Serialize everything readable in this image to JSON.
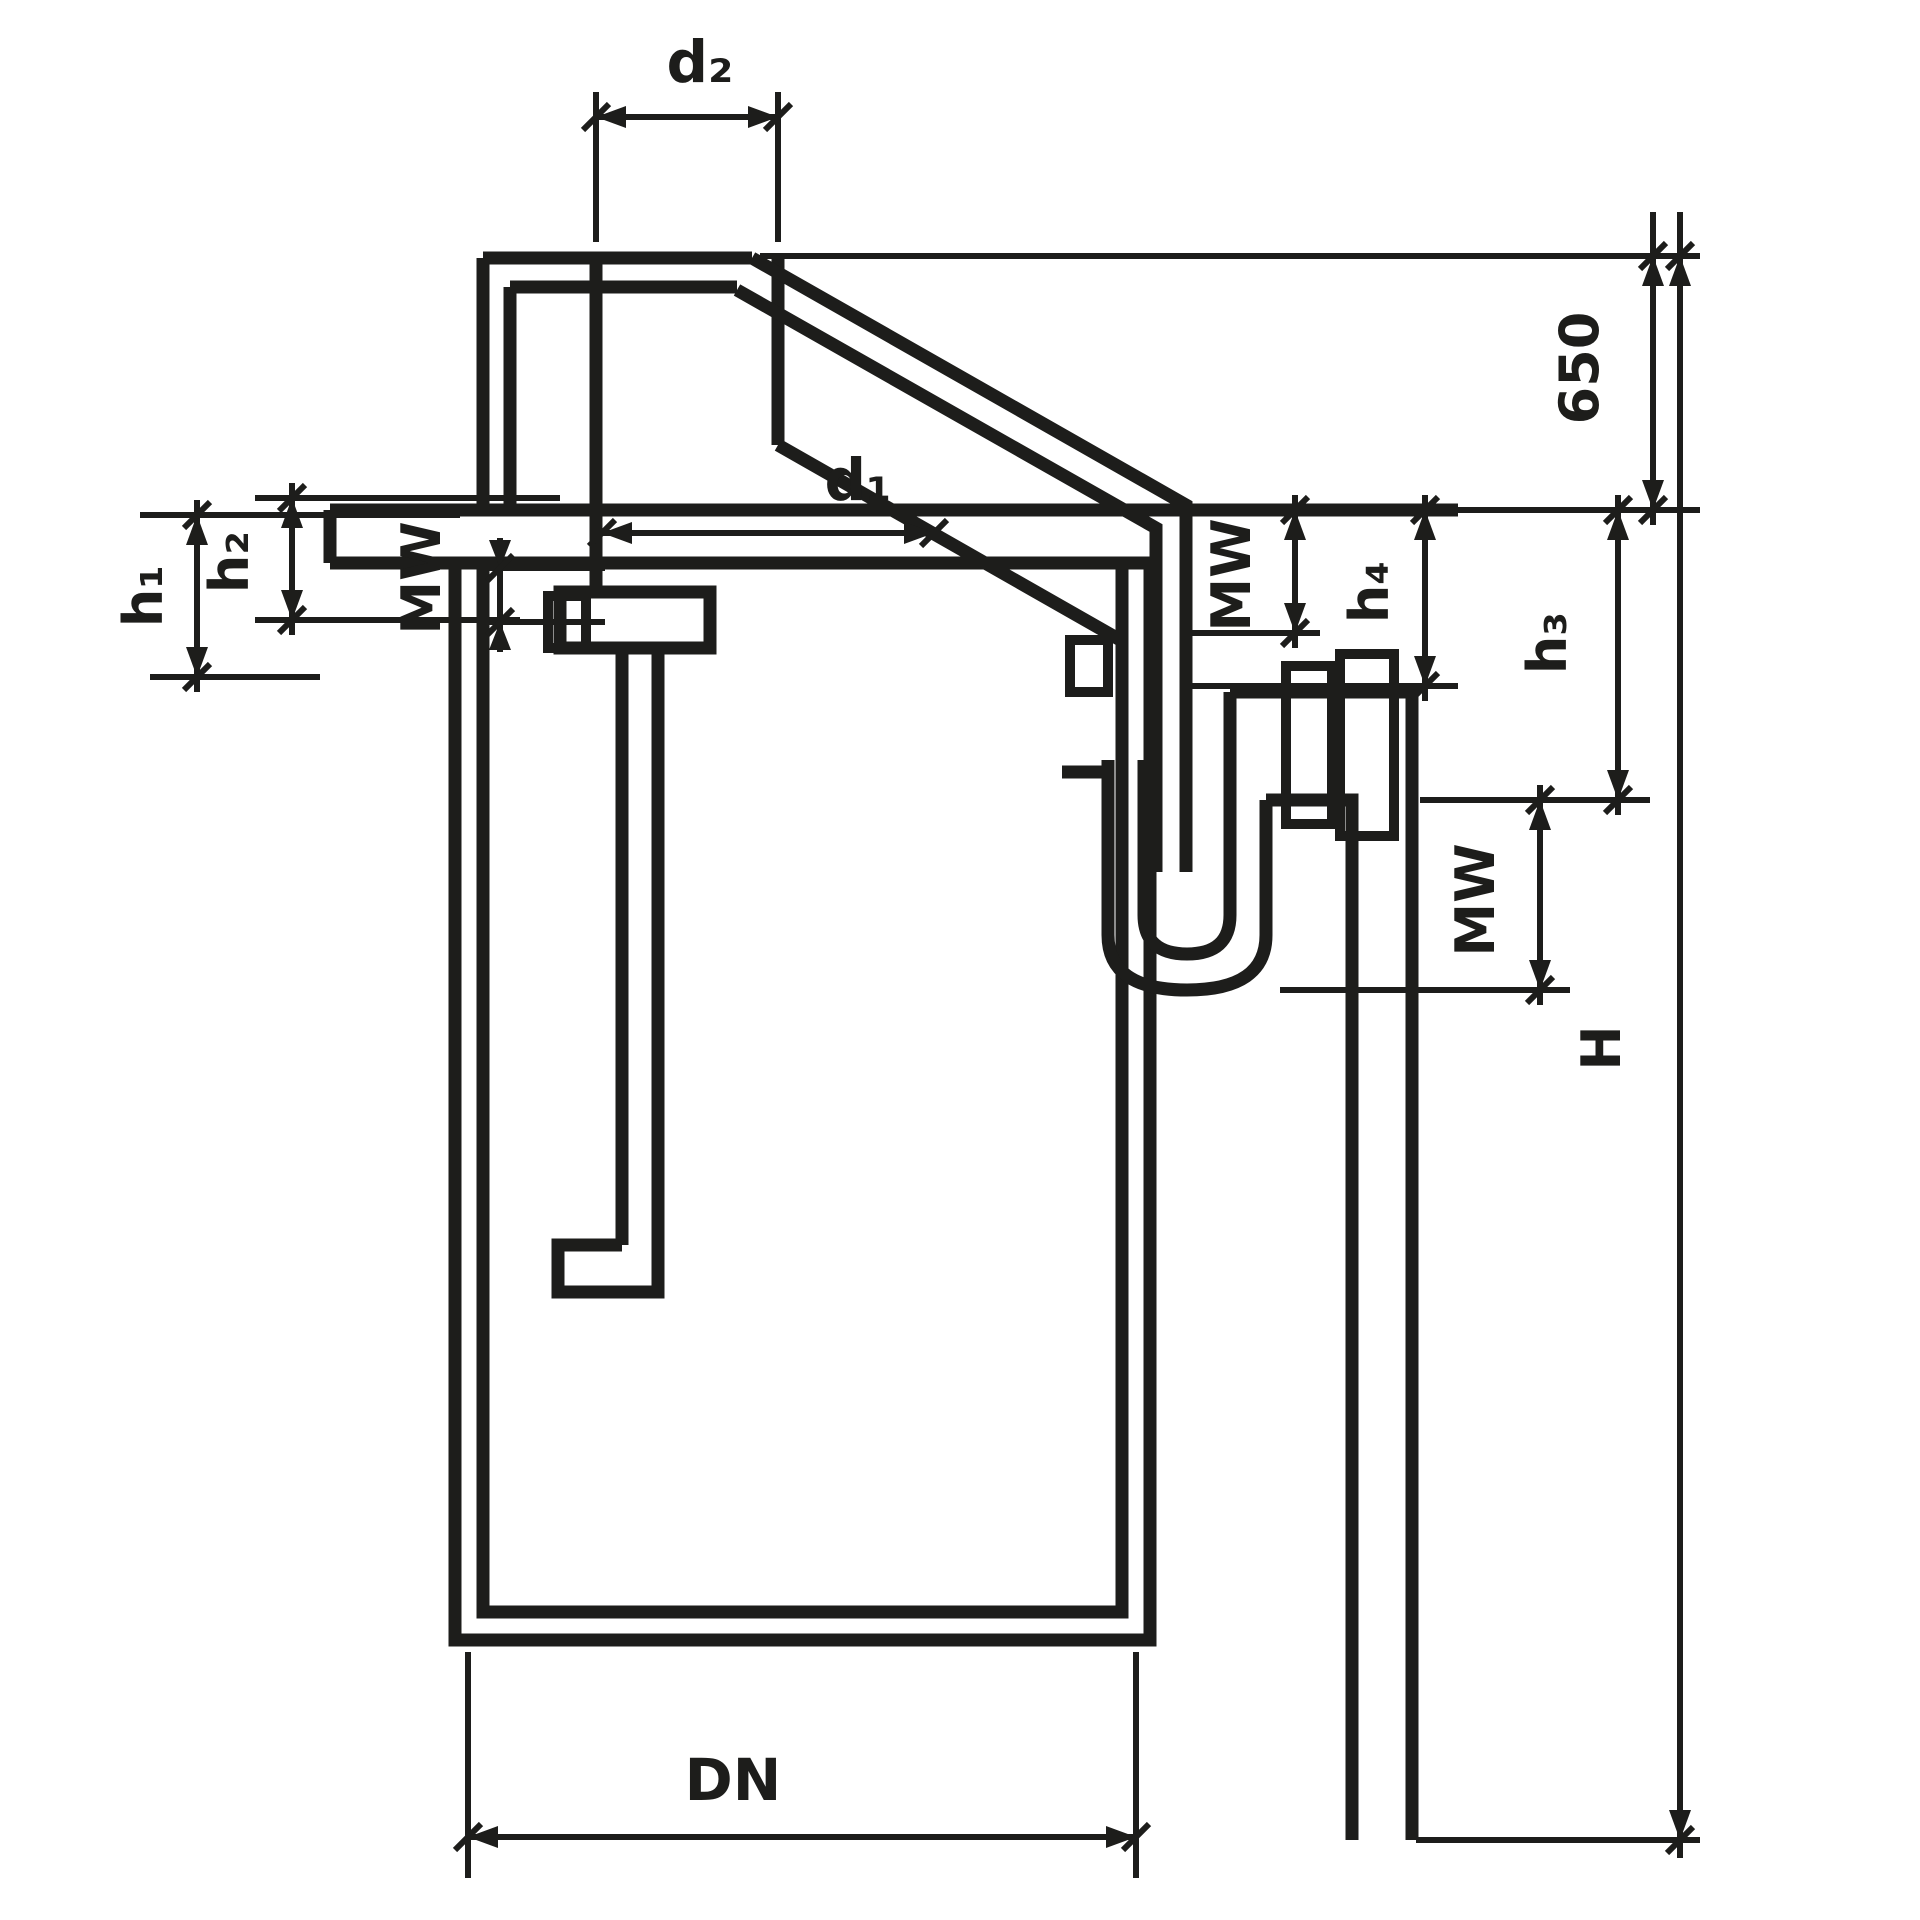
{
  "drawing": {
    "labels": {
      "d2": "d₂",
      "d1": "d₁",
      "dn": "DN",
      "h1": "h₁",
      "h2": "h₂",
      "h3": "h₃",
      "h4": "h₄",
      "mw_left": "MW",
      "mw_middle": "MW",
      "mw_right": "MW",
      "depth_650": "650",
      "total_height": "H"
    },
    "colors": {
      "line": "#1d1d1b",
      "background": "#ffffff"
    }
  }
}
